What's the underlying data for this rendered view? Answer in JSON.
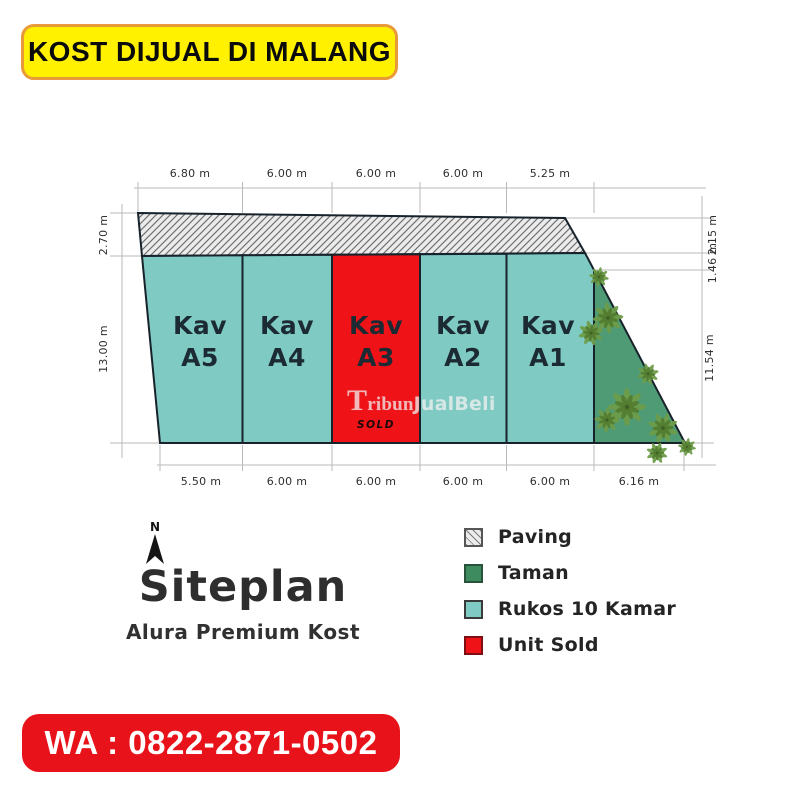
{
  "banner_top": {
    "text": "KOST DIJUAL DI MALANG"
  },
  "banner_bottom": {
    "text": "WA : 0822-2871-0502"
  },
  "watermark": {
    "part1": "Tribun",
    "part2": "JualBeli"
  },
  "siteplan": {
    "north_label": "N",
    "heading": "Siteplan",
    "subheading": "Alura Premium Kost",
    "plots": [
      {
        "id": "A5",
        "line1": "Kav",
        "line2": "A5",
        "status": "available"
      },
      {
        "id": "A4",
        "line1": "Kav",
        "line2": "A4",
        "status": "available"
      },
      {
        "id": "A3",
        "line1": "Kav",
        "line2": "A3",
        "status": "sold",
        "sold_label": "SOLD"
      },
      {
        "id": "A2",
        "line1": "Kav",
        "line2": "A2",
        "status": "available"
      },
      {
        "id": "A1",
        "line1": "Kav",
        "line2": "A1",
        "status": "available"
      }
    ],
    "dimensions": {
      "top": [
        "6.80 m",
        "6.00 m",
        "6.00 m",
        "6.00 m",
        "5.25 m"
      ],
      "bottom": [
        "5.50 m",
        "6.00 m",
        "6.00 m",
        "6.00 m",
        "6.00 m",
        "6.16 m"
      ],
      "left": [
        "2.70 m",
        "13.00 m"
      ],
      "right": [
        "2.15 m",
        "1.46 m",
        "11.54 m"
      ]
    }
  },
  "legend": {
    "items": [
      {
        "label": "Paving",
        "swatch": "paving"
      },
      {
        "label": "Taman",
        "swatch": "taman"
      },
      {
        "label": "Rukos 10 Kamar",
        "swatch": "rukos"
      },
      {
        "label": "Unit Sold",
        "swatch": "sold"
      }
    ]
  },
  "colors": {
    "yellow": "#FFF100",
    "orange": "#E89A3B",
    "redbanner": "#E8131A",
    "teal": "#7FCBC4",
    "red": "#EF1318",
    "garden": "#4F9B76",
    "taman": "#3E8B60",
    "tree1": "#6D9C49",
    "tree2": "#527B2F",
    "outline": "#17222B",
    "dimline": "#B9B9B9",
    "dimtext": "#2F2F2F",
    "labeldark": "#1C2A33",
    "hatchbg": "#ECECEC",
    "hatchline": "#707070",
    "titletext": "#2E2E2E"
  }
}
